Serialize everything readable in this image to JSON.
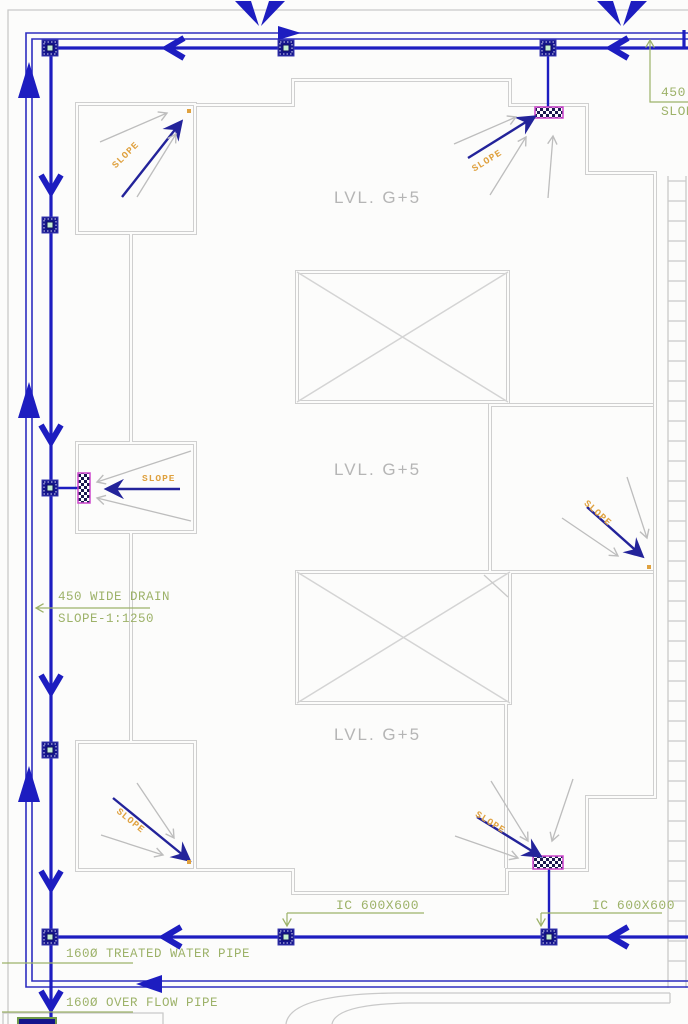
{
  "colors": {
    "pipe-blue": "#1d1dc0",
    "overflow-blue": "#2e2ec0",
    "slope-navy": "#23239a",
    "annotation-green": "#9db269",
    "slope-orange": "#dfa13f",
    "drain-magenta": "#cc44cc",
    "outline-gray": "#cfcfcf",
    "label-gray": "#b5b5b5",
    "junction-navy": "#14148c",
    "junction-center-green": "#c6efcf"
  },
  "levels": {
    "top": "LVL. G+5",
    "middle": "LVL. G+5",
    "bottom": "LVL. G+5"
  },
  "slopes": [
    "SLOPE",
    "SLOPE",
    "SLOPE",
    "SLOPE",
    "SLOPE",
    "SLOPE"
  ],
  "annotations": {
    "wide_drain": "450 WIDE DRAIN",
    "wide_drain_slope": "SLOPE-1:1250",
    "edge_drain_width": "450",
    "edge_drain_slope": "SLOPE",
    "ic_left": "IC 600X600",
    "ic_right": "IC 600X600",
    "treated_pipe": "160Ø TREATED WATER PIPE",
    "overflow_pipe": "160Ø OVER FLOW PIPE"
  }
}
